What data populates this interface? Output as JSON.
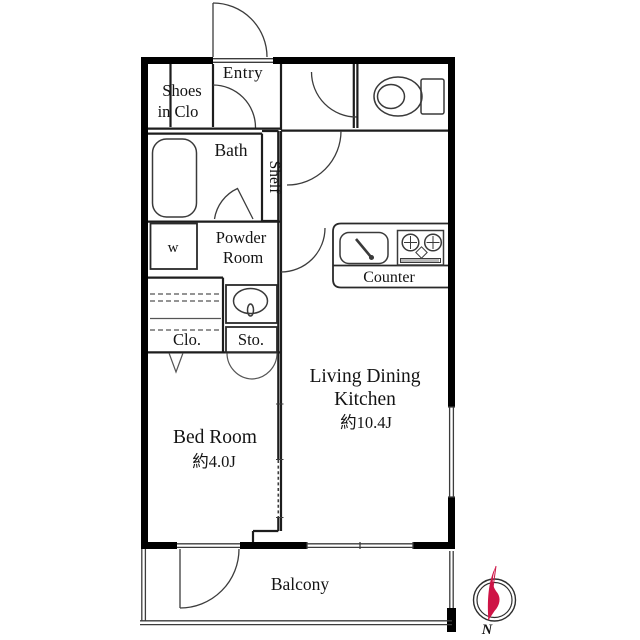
{
  "title": "1K apartment floor plan",
  "colors": {
    "wall": "#000000",
    "line": "#3c3c3c",
    "compass_red": "#ce1446",
    "background": "#ffffff"
  },
  "rooms": {
    "entry": {
      "label": "Entry"
    },
    "shoes_closet": {
      "line1": "Shoes",
      "line2": "in Clo"
    },
    "bath": {
      "label": "Bath"
    },
    "shelf": {
      "label": "Shelf"
    },
    "powder_room": {
      "line1": "Powder",
      "line2": "Room"
    },
    "washer": {
      "label": "w"
    },
    "counter": {
      "label": "Counter"
    },
    "closet": {
      "label": "Clo."
    },
    "storage": {
      "label": "Sto."
    },
    "living_dining_kitchen": {
      "line1": "Living Dining",
      "line2": "Kitchen",
      "size": "約10.4J"
    },
    "bedroom": {
      "label": "Bed Room",
      "size": "約4.0J"
    },
    "balcony": {
      "label": "Balcony"
    }
  },
  "compass": {
    "north_label": "N"
  },
  "icons": [
    "bathtub-icon",
    "toilet-icon",
    "wash-basin-icon",
    "kitchen-sink-icon",
    "stove-icon",
    "compass-icon"
  ]
}
